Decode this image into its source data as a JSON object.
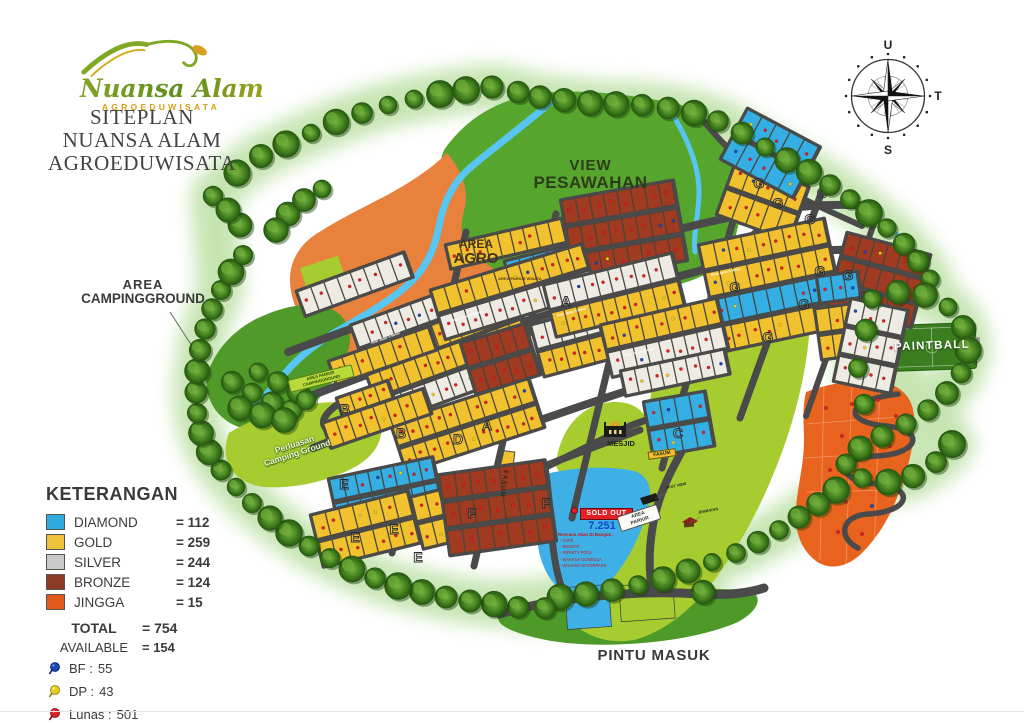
{
  "brand": {
    "script": "Nuansa Alam",
    "sub": "AGROEDUWISATA"
  },
  "title": {
    "line1": "SITEPLAN",
    "line2": "NUANSA ALAM",
    "line3": "AGROEDUWISATA"
  },
  "compass": {
    "north": "U",
    "east": "T",
    "south": "S"
  },
  "map_labels": {
    "view_line1": "VIEW",
    "view_line2": "PESAWAHAN",
    "agro_line1": "AREA",
    "agro_line2": "AGRO",
    "agro_parkir": "AREA PARKIR WISATA",
    "camping_line1": "AREA",
    "camping_line2": "CAMPINGGROUND",
    "camping_parkir_line1": "AREA PARKIR",
    "camping_parkir_line2": "CAMPINGGROUND",
    "perluasan_line1": "Perluasan",
    "perluasan_line2": "Camping Ground",
    "paintball": "PAINTBALL",
    "mesjid": "MESJID",
    "fasum": "FASUM",
    "area_parkir_line1": "AREA",
    "area_parkir_line2": "PARKIR",
    "spot_view": "SPOT VIEW",
    "jembatan": "JEMBATAN",
    "pintu_masuk": "PINTU MASUK",
    "road_label": "Row Jalan 5 Meter",
    "sold_out": {
      "badge": "SOLD OUT",
      "area_value": "7.251",
      "plan_title": "Rencana Akan Di Bangun :",
      "plan_items": [
        "- CAFE",
        "- RESORT",
        "- INFINITY POOL",
        "- WAHANA GONDOLA",
        "- WAHANA WATERPARK"
      ]
    }
  },
  "plot_block_letters": [
    {
      "t": "A",
      "x": 487,
      "y": 430
    },
    {
      "t": "A",
      "x": 566,
      "y": 306
    },
    {
      "t": "B",
      "x": 345,
      "y": 414
    },
    {
      "t": "B",
      "x": 401,
      "y": 438
    },
    {
      "t": "C",
      "x": 678,
      "y": 438
    },
    {
      "t": "C",
      "x": 822,
      "y": 198
    },
    {
      "t": "D",
      "x": 458,
      "y": 444
    },
    {
      "t": "E",
      "x": 344,
      "y": 489
    },
    {
      "t": "E",
      "x": 355,
      "y": 542
    },
    {
      "t": "E",
      "x": 394,
      "y": 534
    },
    {
      "t": "E",
      "x": 418,
      "y": 562
    },
    {
      "t": "F",
      "x": 472,
      "y": 518
    },
    {
      "t": "F",
      "x": 546,
      "y": 508
    },
    {
      "t": "G",
      "x": 759,
      "y": 188
    },
    {
      "t": "G",
      "x": 778,
      "y": 208
    },
    {
      "t": "G",
      "x": 810,
      "y": 224
    },
    {
      "t": "G",
      "x": 820,
      "y": 276
    },
    {
      "t": "G",
      "x": 848,
      "y": 280
    },
    {
      "t": "G",
      "x": 804,
      "y": 309
    },
    {
      "t": "G",
      "x": 864,
      "y": 302
    },
    {
      "t": "G",
      "x": 735,
      "y": 292
    },
    {
      "t": "G",
      "x": 768,
      "y": 342
    },
    {
      "t": "G",
      "x": 832,
      "y": 194
    }
  ],
  "legend": {
    "heading": "KETERANGAN",
    "items": [
      {
        "label": "DIAMOND",
        "count": "= 112",
        "color": "#2FA8DC"
      },
      {
        "label": "GOLD",
        "count": "= 259",
        "color": "#F0C23C"
      },
      {
        "label": "SILVER",
        "count": "= 244",
        "color": "#C9C9C9"
      },
      {
        "label": "BRONZE",
        "count": "= 124",
        "color": "#8C3A24"
      },
      {
        "label": "JINGGA",
        "count": "= 15",
        "color": "#E2591C"
      }
    ],
    "total_label": "TOTAL",
    "total_value": "= 754",
    "available_label": "AVAILABLE",
    "available_value": "= 154",
    "pins": [
      {
        "label": "BF :",
        "value": "55",
        "color": "#1F44B4"
      },
      {
        "label": "DP :",
        "value": "43",
        "color": "#E6CF1E"
      },
      {
        "label": "Lunas :",
        "value": "501",
        "color": "#E01E26"
      }
    ]
  },
  "colors": {
    "diamond": "#35AEE4",
    "gold": "#F2C12E",
    "silver_plot": "#EDEBE4",
    "bronze": "#A03A20",
    "jingga": "#E8631E",
    "lime": "#A6CC30",
    "grass": "#56A52C",
    "road": "#4A4A4A",
    "river": "#58C6F2",
    "pin_red": "#E01E26",
    "pin_blue": "#1F44B4",
    "pin_yellow": "#E6CF1E"
  }
}
